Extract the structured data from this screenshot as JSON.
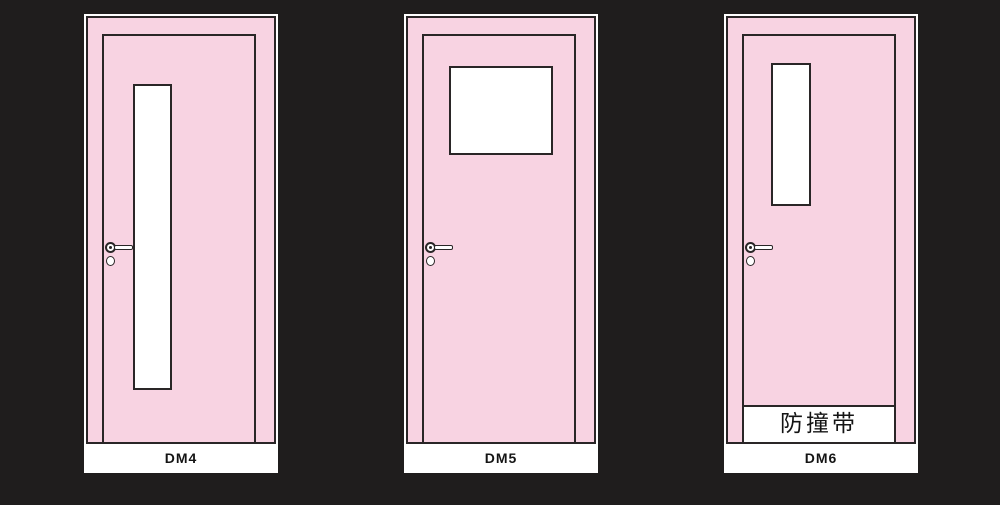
{
  "colors": {
    "background": "#1f1d1d",
    "door_fill": "#f8d3e2",
    "outline": "#2a2627",
    "glass": "#ffffff",
    "label_bg": "#ffffff",
    "text": "#141414"
  },
  "doors": [
    {
      "label": "DM4"
    },
    {
      "label": "DM5"
    },
    {
      "label": "DM6",
      "strip_label": "防撞带"
    }
  ]
}
